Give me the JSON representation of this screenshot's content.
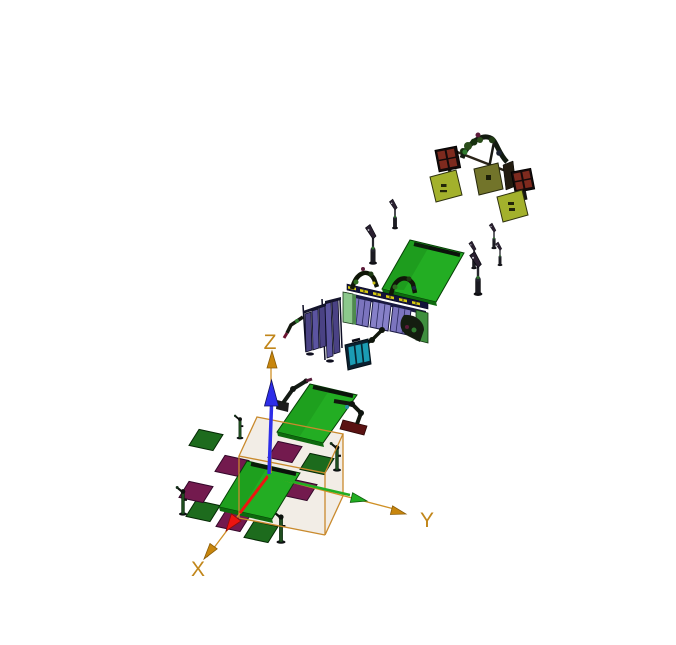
{
  "viewport": {
    "kind": "3d-simulation-viewport",
    "background": "#ffffff"
  },
  "axes": {
    "x": {
      "label": "X",
      "color": "#ed1410"
    },
    "y": {
      "label": "Y",
      "color": "#22ad22"
    },
    "z": {
      "label": "Z",
      "color": "#2d2de8"
    }
  },
  "palette": {
    "bg": "#ffffff",
    "axis-orange": "#c8860d",
    "axis-line-orange": "#cf9025",
    "axis-label": "#c1861a",
    "axis-red": "#ed1410",
    "axis-green": "#22ad22",
    "axis-blue": "#2d2de8",
    "table-green": "#23ad23",
    "table-green-dark": "#0e6a0e",
    "table-strip": "#0b130b",
    "plate-green": "#1d6b1d",
    "plate-maroon": "#731a4e",
    "floor-beige": "#f2ede6",
    "wire-orange": "#c98a2d",
    "panel-purple": "#7b74be",
    "panel-purple-alt": "#8680c8",
    "panel-navy": "#14143a",
    "slat-purple": "#4a4284",
    "slat-purple-alt": "#5b54a0",
    "support-green": "#8cc88c",
    "pedestal-green": "#3f8f3f",
    "teal-cell": "#1b9cb4",
    "teal-frame": "#0c2030",
    "yellow-strip": "#d6ca12",
    "olive-bright": "#a3b12c",
    "olive-dark": "#72742a",
    "check-red": "#7e2a1e",
    "check-base": "#140a0a",
    "robot-dark": "#121a10",
    "robot-green": "#2f7a2f",
    "robot-maroon": "#5c1b3a"
  }
}
